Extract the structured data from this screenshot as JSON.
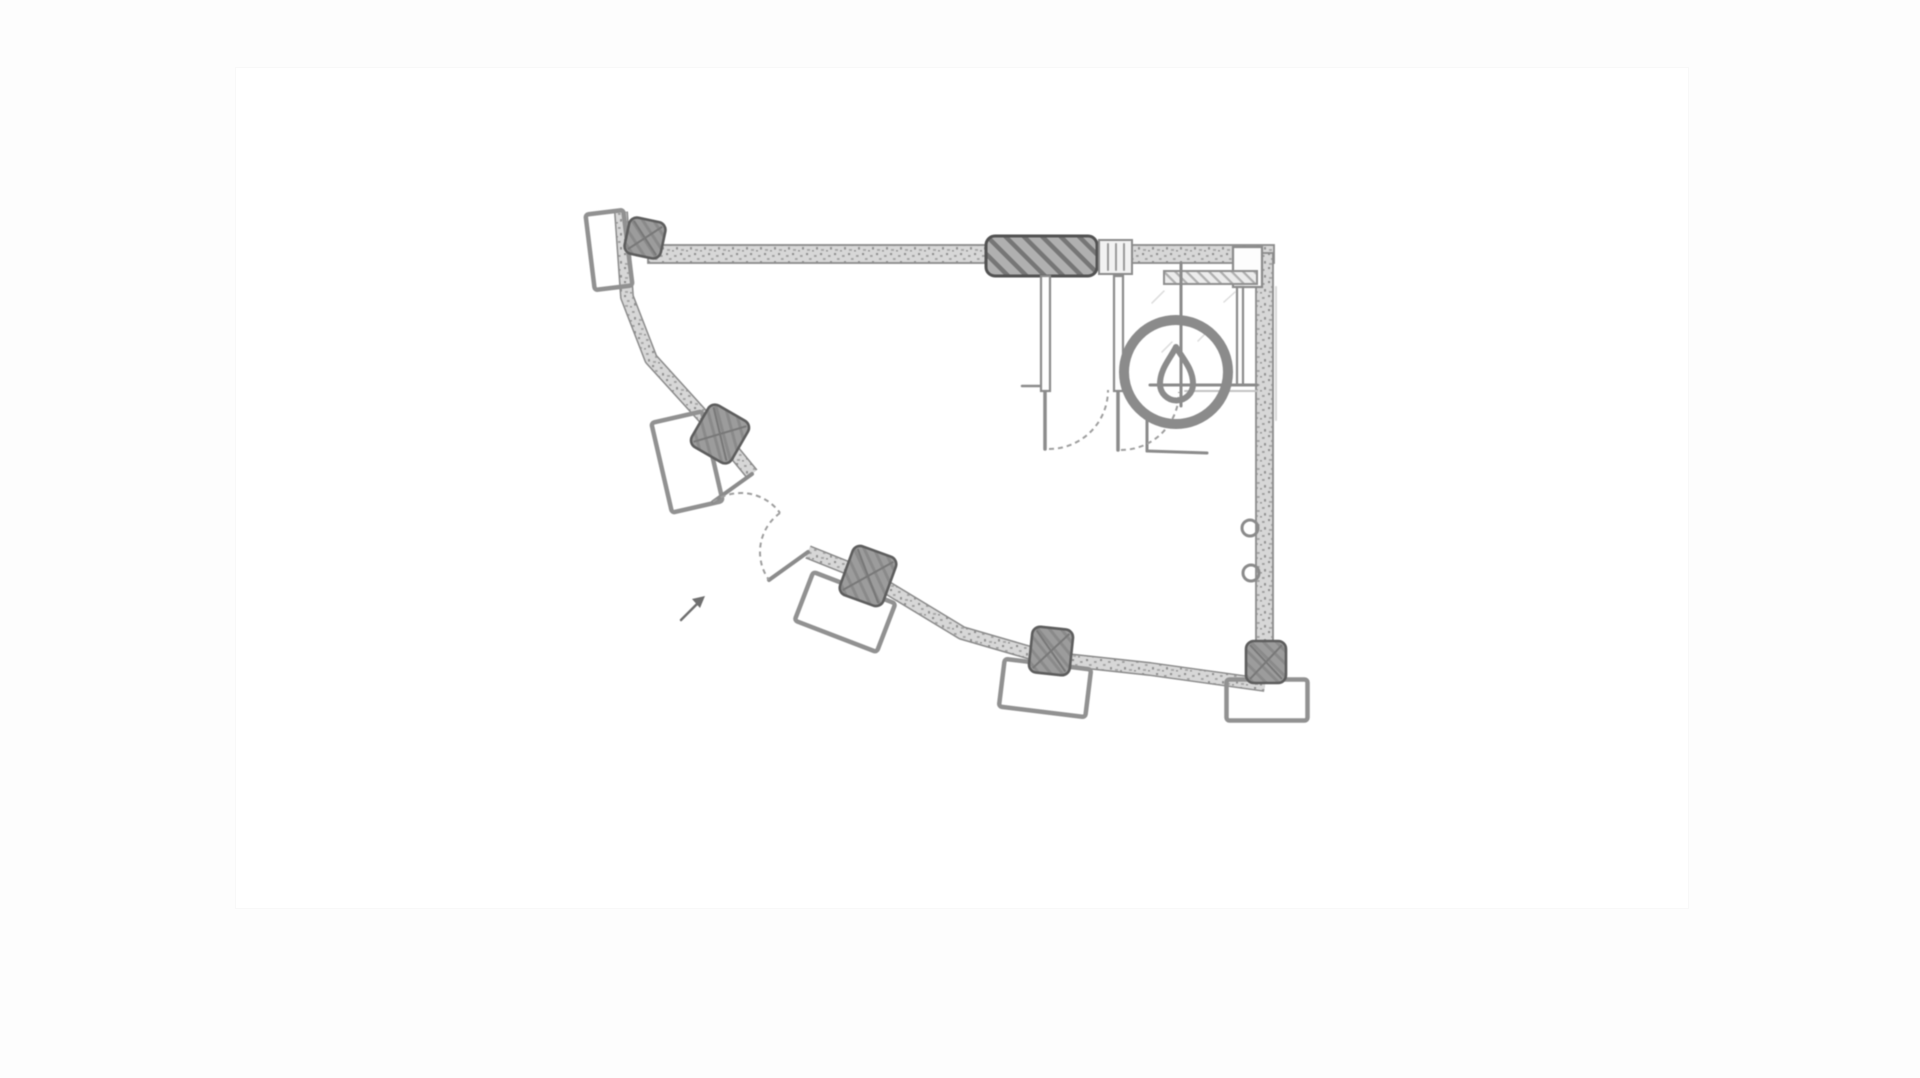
{
  "app": {
    "title": "floor-plan-canvas",
    "visible_text": ""
  },
  "canvas": {
    "background": "#fdfdfd",
    "dot_color": "#b6b6b6",
    "dot_spacing": 24,
    "artboard": {
      "x": 236,
      "y": 68,
      "w": 1452,
      "h": 840
    }
  },
  "plan": {
    "colors": {
      "ink": "#8b8b8b",
      "ink_light": "#9e9e9e",
      "ink_dark": "#5d5d5d",
      "lintel_border": "#525252",
      "white": "#fdfdfd",
      "faint": "#d6d6d6",
      "cursor": "#6f6f6f"
    },
    "bands": [
      {
        "name": "curved-wall-upper",
        "w": 11,
        "pts": [
          [
            621,
            212
          ],
          [
            627,
            297
          ],
          [
            651,
            359
          ],
          [
            720,
            435
          ],
          [
            752,
            474
          ]
        ]
      },
      {
        "name": "curved-wall-lower",
        "w": 11,
        "pts": [
          [
            808,
            552
          ],
          [
            868,
            576
          ],
          [
            962,
            633
          ],
          [
            1048,
            658
          ],
          [
            1150,
            669
          ],
          [
            1265,
            685
          ]
        ]
      }
    ],
    "walls": [
      {
        "name": "top-wall-left",
        "x": 648,
        "y": 245,
        "w": 340,
        "h": 18
      },
      {
        "name": "top-wall-right",
        "x": 1129,
        "y": 245,
        "w": 145,
        "h": 18
      },
      {
        "name": "right-wall",
        "x": 1256,
        "y": 253,
        "w": 17,
        "h": 395
      }
    ],
    "lintel": {
      "name": "hatched-lintel",
      "x": 986,
      "y": 236,
      "w": 111,
      "h": 40,
      "rx": 9
    },
    "threshold": {
      "name": "door-threshold",
      "x": 1099,
      "y": 240,
      "w": 33,
      "h": 34
    },
    "boxes": [
      {
        "name": "partition-stub-1",
        "x": 1041,
        "y": 276,
        "w": 9,
        "h": 115
      },
      {
        "name": "partition-stub-2",
        "x": 1114,
        "y": 276,
        "w": 9,
        "h": 115
      },
      {
        "name": "corner-pilaster",
        "x": 1233,
        "y": 247,
        "w": 29,
        "h": 40
      },
      {
        "name": "partition-b",
        "x": 1237,
        "y": 287,
        "w": 6,
        "h": 98
      }
    ],
    "shelf": {
      "name": "wall-shelf",
      "x": 1164,
      "y": 271,
      "w": 93,
      "h": 13
    },
    "frames": [
      {
        "name": "window-frame-1",
        "cx": 609,
        "cy": 250,
        "w": 38,
        "h": 76,
        "rot": -7
      },
      {
        "name": "window-frame-2",
        "cx": 687,
        "cy": 462,
        "w": 52,
        "h": 92,
        "rot": -13
      },
      {
        "name": "window-frame-3",
        "cx": 845,
        "cy": 612,
        "w": 88,
        "h": 52,
        "rot": 21
      },
      {
        "name": "window-frame-4",
        "cx": 1045,
        "cy": 688,
        "w": 87,
        "h": 48,
        "rot": 7
      },
      {
        "name": "window-frame-5",
        "cx": 1267,
        "cy": 700,
        "w": 81,
        "h": 41,
        "rot": 0
      }
    ],
    "columns": [
      {
        "name": "column-1",
        "cx": 645,
        "cy": 238,
        "w": 37,
        "h": 37,
        "rot": 12
      },
      {
        "name": "column-2",
        "cx": 720,
        "cy": 434,
        "w": 46,
        "h": 48,
        "rot": 30
      },
      {
        "name": "column-3",
        "cx": 868,
        "cy": 576,
        "w": 46,
        "h": 52,
        "rot": 20
      },
      {
        "name": "column-4",
        "cx": 1051,
        "cy": 651,
        "w": 41,
        "h": 46,
        "rot": 6
      },
      {
        "name": "column-5",
        "cx": 1266,
        "cy": 662,
        "w": 40,
        "h": 42,
        "rot": 0
      }
    ],
    "lines": [
      {
        "name": "door-leaf-ext-1",
        "x1": 752,
        "y1": 474,
        "x2": 713,
        "y2": 502,
        "w": 4
      },
      {
        "name": "door-leaf-ext-2",
        "x1": 808,
        "y1": 552,
        "x2": 769,
        "y2": 580,
        "w": 4
      },
      {
        "name": "door-leaf-int-1",
        "x1": 1045,
        "y1": 392,
        "x2": 1045,
        "y2": 449,
        "w": 3.5
      },
      {
        "name": "door-leaf-int-2",
        "x1": 1118,
        "y1": 392,
        "x2": 1118,
        "y2": 450,
        "w": 3.5
      },
      {
        "name": "partition-a",
        "x1": 1181,
        "y1": 263,
        "x2": 1181,
        "y2": 406,
        "w": 3
      },
      {
        "name": "counter-edge",
        "x1": 1150,
        "y1": 385,
        "x2": 1257,
        "y2": 385,
        "w": 3
      },
      {
        "name": "counter-edge-2",
        "x1": 1185,
        "y1": 391,
        "x2": 1257,
        "y2": 391,
        "w": 2,
        "color": "#c4c4c4"
      },
      {
        "name": "stall-side",
        "x1": 1147,
        "y1": 413,
        "x2": 1147,
        "y2": 451,
        "w": 3
      },
      {
        "name": "stall-bottom",
        "x1": 1147,
        "y1": 451,
        "x2": 1207,
        "y2": 453,
        "w": 3
      },
      {
        "name": "wall-tick",
        "x1": 1022,
        "y1": 386,
        "x2": 1040,
        "y2": 386,
        "w": 2.5
      },
      {
        "name": "outer-shadow",
        "x1": 1276,
        "y1": 287,
        "x2": 1276,
        "y2": 420,
        "w": 2,
        "color": "#d9d9d9"
      },
      {
        "name": "threshold-line-1",
        "x1": 1108,
        "y1": 244,
        "x2": 1108,
        "y2": 270,
        "w": 2,
        "color": "#9a9a9a"
      },
      {
        "name": "threshold-line-2",
        "x1": 1116,
        "y1": 244,
        "x2": 1116,
        "y2": 270,
        "w": 2,
        "color": "#9a9a9a"
      },
      {
        "name": "threshold-line-3",
        "x1": 1124,
        "y1": 244,
        "x2": 1124,
        "y2": 270,
        "w": 2,
        "color": "#9a9a9a"
      },
      {
        "name": "room-hatch-1",
        "x1": 1152,
        "y1": 303,
        "x2": 1164,
        "y2": 291,
        "w": 1.5,
        "color": "#dcdcdc"
      },
      {
        "name": "room-hatch-2",
        "x1": 1198,
        "y1": 341,
        "x2": 1210,
        "y2": 329,
        "w": 1.5,
        "color": "#dcdcdc"
      },
      {
        "name": "room-hatch-3",
        "x1": 1162,
        "y1": 352,
        "x2": 1172,
        "y2": 342,
        "w": 1.5,
        "color": "#dcdcdc"
      },
      {
        "name": "room-hatch-4",
        "x1": 1224,
        "y1": 302,
        "x2": 1235,
        "y2": 292,
        "w": 1.5,
        "color": "#dcdcdc"
      },
      {
        "name": "cursor-tail",
        "x1": 681,
        "y1": 620,
        "x2": 699,
        "y2": 602,
        "w": 2.5,
        "color": "#6f6f6f"
      }
    ],
    "arcs": [
      {
        "name": "door-swing-ext-1",
        "d": "M713,502 A48,48 0 0 1 780,513"
      },
      {
        "name": "door-swing-ext-2",
        "d": "M780,513 A48,48 0 0 0 769,580"
      },
      {
        "name": "door-swing-int-1",
        "d": "M1049,449 A59,59 0 0 0 1108,390"
      },
      {
        "name": "door-swing-int-2",
        "d": "M1121,450 A58,58 0 0 0 1179,392"
      }
    ],
    "circles": [
      {
        "name": "floor-drain-ring",
        "cx": 1176,
        "cy": 372,
        "r": 52,
        "sw": 10
      },
      {
        "name": "pipe-fitting-1",
        "cx": 1250,
        "cy": 528,
        "r": 8,
        "sw": 3
      },
      {
        "name": "pipe-fitting-2",
        "cx": 1251,
        "cy": 573,
        "r": 8,
        "sw": 3
      }
    ],
    "paths": [
      {
        "name": "water-drop-icon",
        "d": "M1176,347 C1170,359 1160,369 1160,384 A16.5,16.5 0 1 0 1193,384 C1193,369 1183,359 1176,347 Z",
        "sw": 6,
        "fill": "none",
        "color": "#8b8b8b"
      },
      {
        "name": "cursor-arrowhead-icon",
        "d": "M705,596 L692,599 L700,608 Z",
        "sw": 0,
        "fill": "#6f6f6f",
        "color": "none"
      }
    ]
  }
}
